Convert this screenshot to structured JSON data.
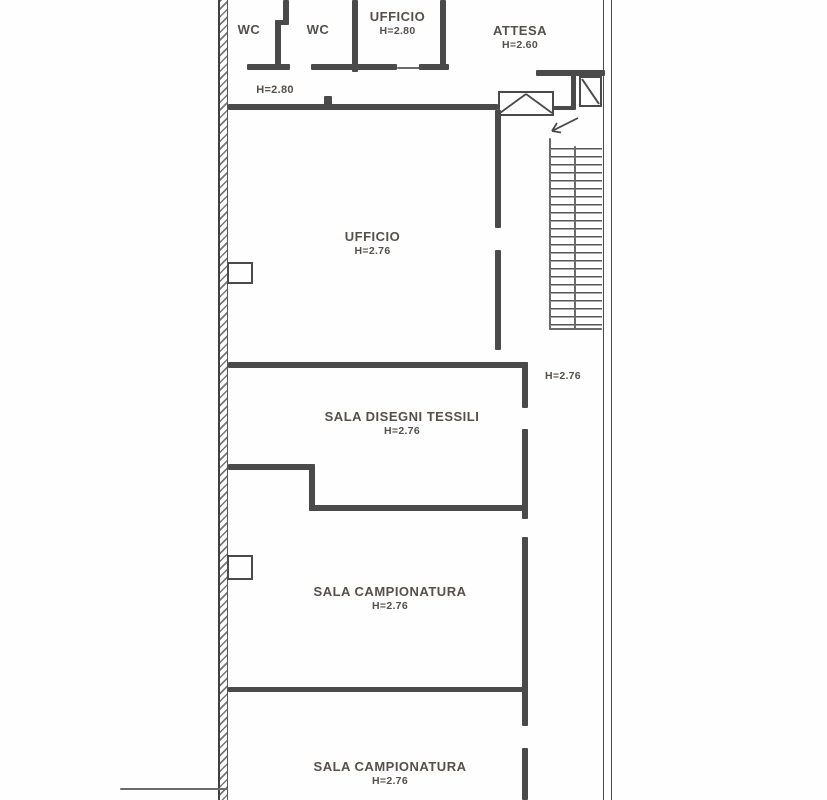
{
  "document": {
    "type": "architectural-floor-plan",
    "language": "it"
  },
  "rooms": {
    "wc1": {
      "label": "WC"
    },
    "wc2": {
      "label": "WC"
    },
    "ufficio_top": {
      "label": "UFFICIO",
      "height": "H=2.80"
    },
    "attesa": {
      "label": "ATTESA",
      "height": "H=2.60"
    },
    "corridoio": {
      "height": "H=2.80"
    },
    "ufficio_main": {
      "label": "UFFICIO",
      "height": "H=2.76"
    },
    "vano_scala": {
      "height": "H=2.76"
    },
    "sala_disegni_tessili": {
      "label": "SALA DISEGNI TESSILI",
      "height": "H=2.76"
    },
    "sala_campionatura_1": {
      "label": "SALA CAMPIONATURA",
      "height": "H=2.76"
    },
    "sala_campionatura_2": {
      "label": "SALA CAMPIONATURA",
      "height": "H=2.76"
    }
  },
  "symbols": {
    "stairs": "staircase-with-direction-arrow",
    "elevator": "elevator-shaft-box",
    "duct": "duct-shaft-box"
  },
  "colors": {
    "wall": "#4a4a4a",
    "text": "#55504b",
    "background": "#fefefe"
  }
}
